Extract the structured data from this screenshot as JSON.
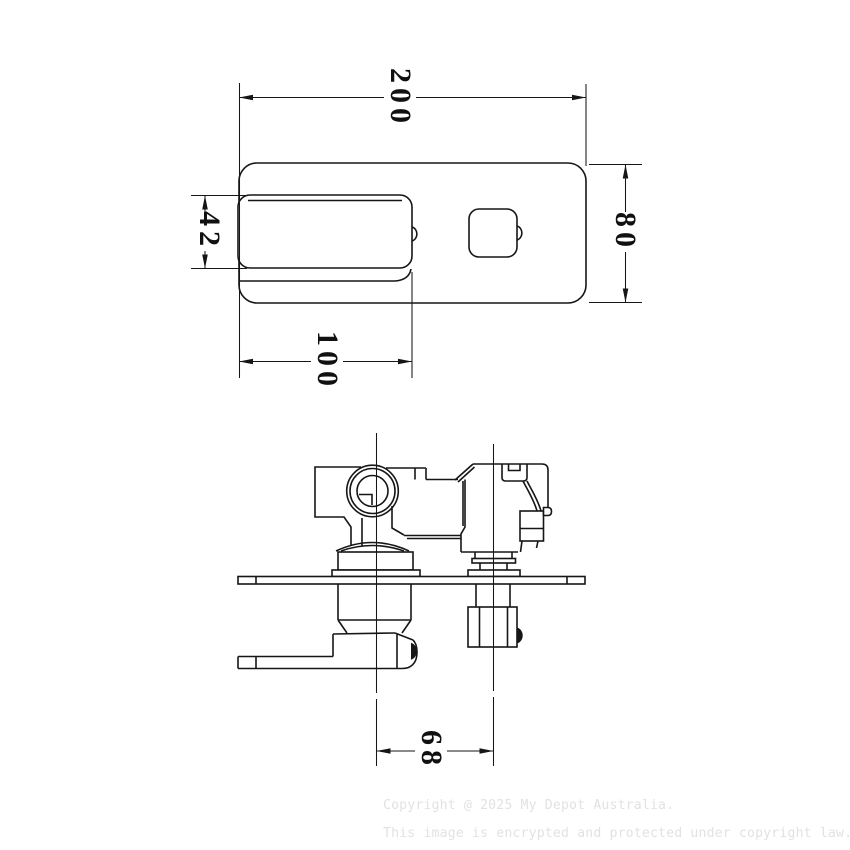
{
  "drawing": {
    "type": "technical-dimension-drawing",
    "product": "wall mixer with diverter",
    "views": [
      {
        "id": "top-view",
        "description": "faceplate plan view"
      },
      {
        "id": "side-view",
        "description": "valve body side elevation"
      }
    ],
    "line_color": "#161616",
    "background_color": "#ffffff"
  },
  "dimensions": {
    "overall_width": "200",
    "overall_height": "80",
    "handle_height": "42",
    "handle_length": "100",
    "valve_center_distance": "68"
  },
  "watermark": {
    "color": "#e2e2e2",
    "line1": "Copyright @ 2025 My Depot Australia.",
    "line2": "This image is encrypted and protected under copyright law."
  }
}
